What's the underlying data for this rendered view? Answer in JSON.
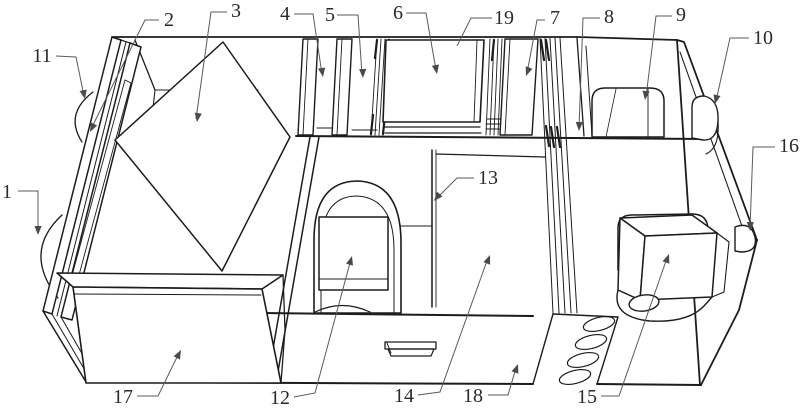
{
  "figure": {
    "background": "#ffffff",
    "line_color": "#1c1c1c",
    "leader_color": "#5a5a5a",
    "labels": [
      "1",
      "2",
      "3",
      "4",
      "5",
      "6",
      "7",
      "8",
      "9",
      "10",
      "11",
      "12",
      "13",
      "14",
      "15",
      "16",
      "17",
      "18",
      "19"
    ]
  }
}
